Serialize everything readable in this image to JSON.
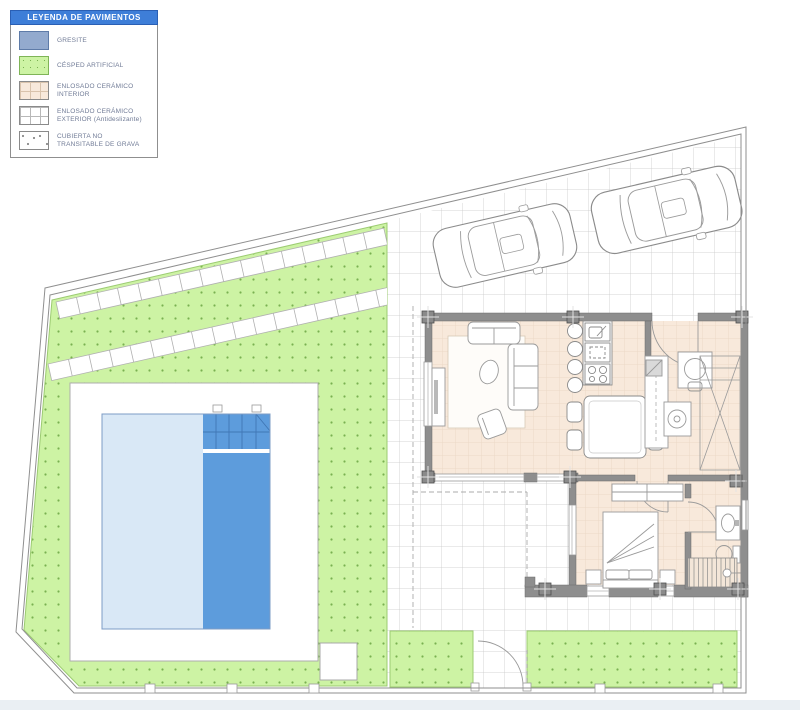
{
  "legend": {
    "title": "LEYENDA DE PAVIMENTOS",
    "header_bg": "#3E7ED8",
    "header_text_color": "#FFFFFF",
    "items": [
      {
        "label": "GRESITE",
        "swatch": "gresite",
        "color": "#93AACE"
      },
      {
        "label": "CÉSPED ARTIFICIAL",
        "swatch": "cesped-artificial",
        "color": "#CDF3A4"
      },
      {
        "label": "ENLOSADO CERÁMICO INTERIOR",
        "swatch": "enlosado-ceramico-interior",
        "color": "#F8E9DB"
      },
      {
        "label": "ENLOSADO CERÁMICO EXTERIOR (Antideslizante)",
        "swatch": "enlosado-ceramico-exterior",
        "color": "#FFFFFF"
      },
      {
        "label": "CUBIERTA NO TRANSITABLE DE GRAVA",
        "swatch": "cubierta-grava",
        "color": "#FFFFFF"
      }
    ]
  },
  "plan": {
    "colors": {
      "artificial_grass": "#CDF3A4",
      "grass_dot": "#79B150",
      "pool_shallow": "#D9E8F6",
      "pool_deep": "#5D9CDC",
      "pool_step_line": "#4077B5",
      "ceramic_interior": "#F8E9DB",
      "exterior_tile_line": "#C9C9C9",
      "wall_fill": "#8E8E8E",
      "boundary_line": "#8F8F8F"
    }
  }
}
